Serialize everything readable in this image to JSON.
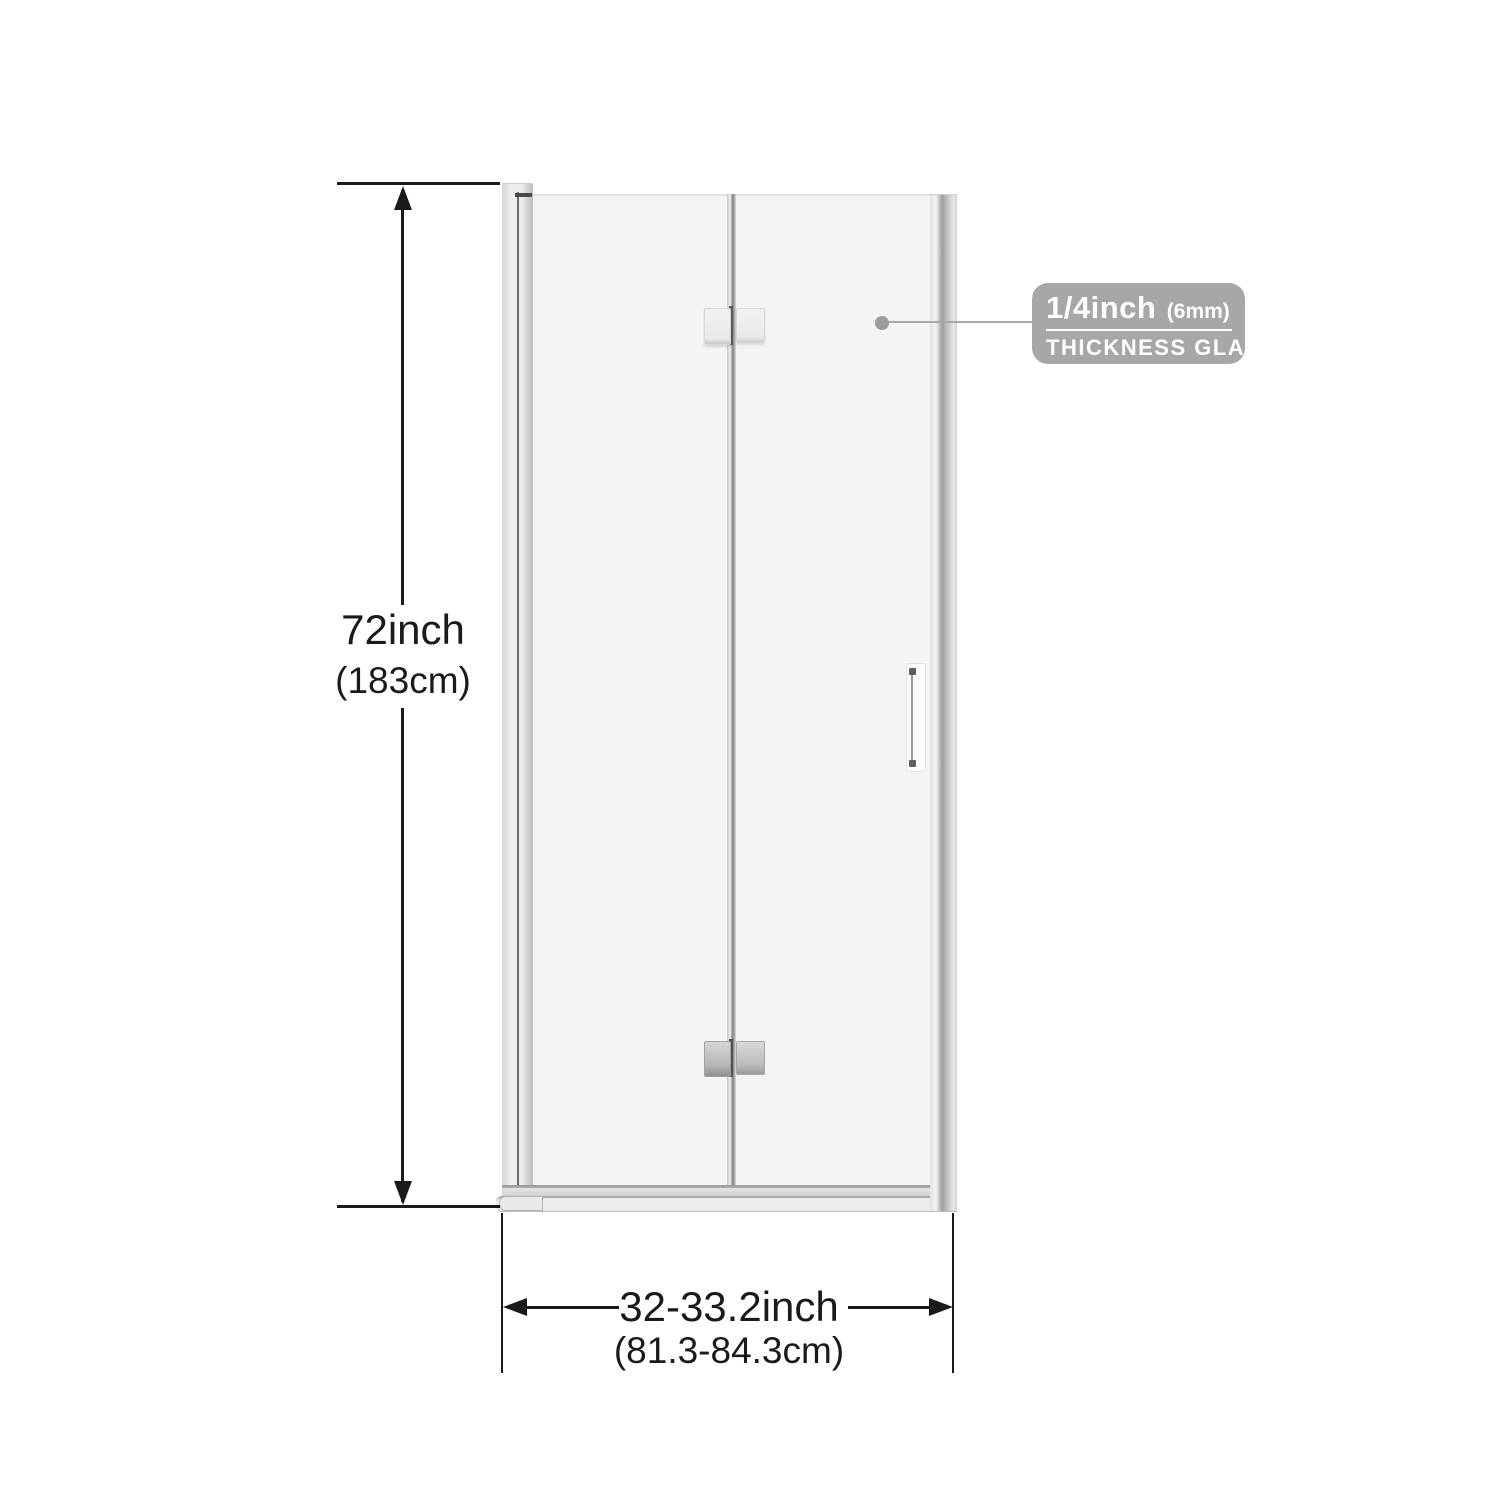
{
  "dimensions": {
    "height": {
      "primary": "72inch",
      "secondary": "(183cm)"
    },
    "width": {
      "primary": "32-33.2inch",
      "secondary": "(81.3-84.3cm)"
    }
  },
  "callout": {
    "size_label": "1/4inch",
    "size_metric": "(6mm)",
    "label": "THICKNESS GLASS"
  },
  "colors": {
    "background": "#ffffff",
    "dimension_line": "#1a1a1a",
    "glass": "#f4f4f5",
    "frame_gray": "#d9d9d9",
    "badge_background": "#a7a7a7",
    "badge_text": "#ffffff",
    "callout_line": "#a8a8a8"
  }
}
